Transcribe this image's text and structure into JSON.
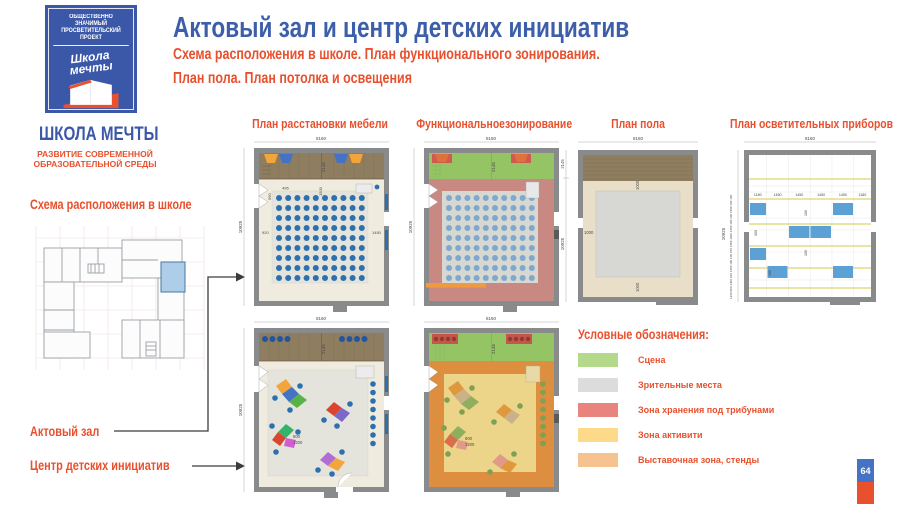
{
  "slide": {
    "title": "Актовый зал и центр детских инициатив",
    "subtitle_line1": "Схема расположения в школе. План функционального зонирования.",
    "subtitle_line2": "План пола. План потолка и освещения",
    "page_number": "64"
  },
  "logo": {
    "project_line1": "ОБЩЕСТВЕННО ЗНАЧИМЫЙ",
    "project_line2": "ПРОСВЕТИТЕЛЬСКИЙ ПРОЕКТ",
    "script_line1": "Школа",
    "script_line2": "мечты",
    "brand": "ШКОЛА МЕЧТЫ",
    "tagline_line1": "РАЗВИТИЕ СОВРЕМЕННОЙ",
    "tagline_line2": "ОБРАЗОВАТЕЛЬНОЙ СРЕДЫ"
  },
  "left_panel": {
    "scheme_label": "Схема расположения в школе",
    "hall_label": "Актовый зал",
    "center_label": "Центр детских инициатив"
  },
  "column_headers": {
    "furniture": "План расстановки мебели",
    "zoning": "Функциональноезонирование",
    "floor": "План пола",
    "lighting": "План осветительных приборов"
  },
  "legend": {
    "title": "Условные обозначения:",
    "items": [
      {
        "label": "Сцена",
        "color": "#b5d98a"
      },
      {
        "label": "Зрительные места",
        "color": "#dcdcdc"
      },
      {
        "label": "Зона хранения  под трибунами",
        "color": "#e8847d"
      },
      {
        "label": "Зона активити",
        "color": "#fcda8a"
      },
      {
        "label": "Выставочная зона, стенды",
        "color": "#f6c28f"
      }
    ]
  },
  "dims": {
    "room_width": "8160",
    "room_height": "10925",
    "stage_depth": "2145",
    "furniture_plan": {
      "d1": "495",
      "d2": "560",
      "d3": "1500",
      "d4": "920",
      "d5": "1450"
    },
    "floor_plan": {
      "border": "1000"
    },
    "lighting_plan": {
      "c1": "1180",
      "c2": "1450",
      "c3": "1450",
      "c4": "1450",
      "c5": "1450",
      "c6": "1180",
      "g1": "100",
      "g2": "300",
      "chain": "1260 900 1400  100  1450  100 100  970  1450  1200  1450  100 100  1500  100 100"
    },
    "initiative_plan": {
      "d1": "600",
      "d2": "1200"
    }
  },
  "colors": {
    "accent_blue": "#3d5fa9",
    "accent_red": "#e8502e",
    "logo_blue": "#3a57a8",
    "badge_blue": "#4472c4",
    "badge_red": "#e8502e",
    "highlight_room": "#aecde9",
    "chair_blue": "#2e70ae",
    "chair_light_blue": "#7fa8cf",
    "stage_wood": "#8f7d60",
    "stage_green": "#94c464",
    "storage_pink": "#c98983",
    "activity_yellow": "#ecd489",
    "expo_orange": "#dd8f3f",
    "light_fixture_blue": "#5ba1d6"
  }
}
